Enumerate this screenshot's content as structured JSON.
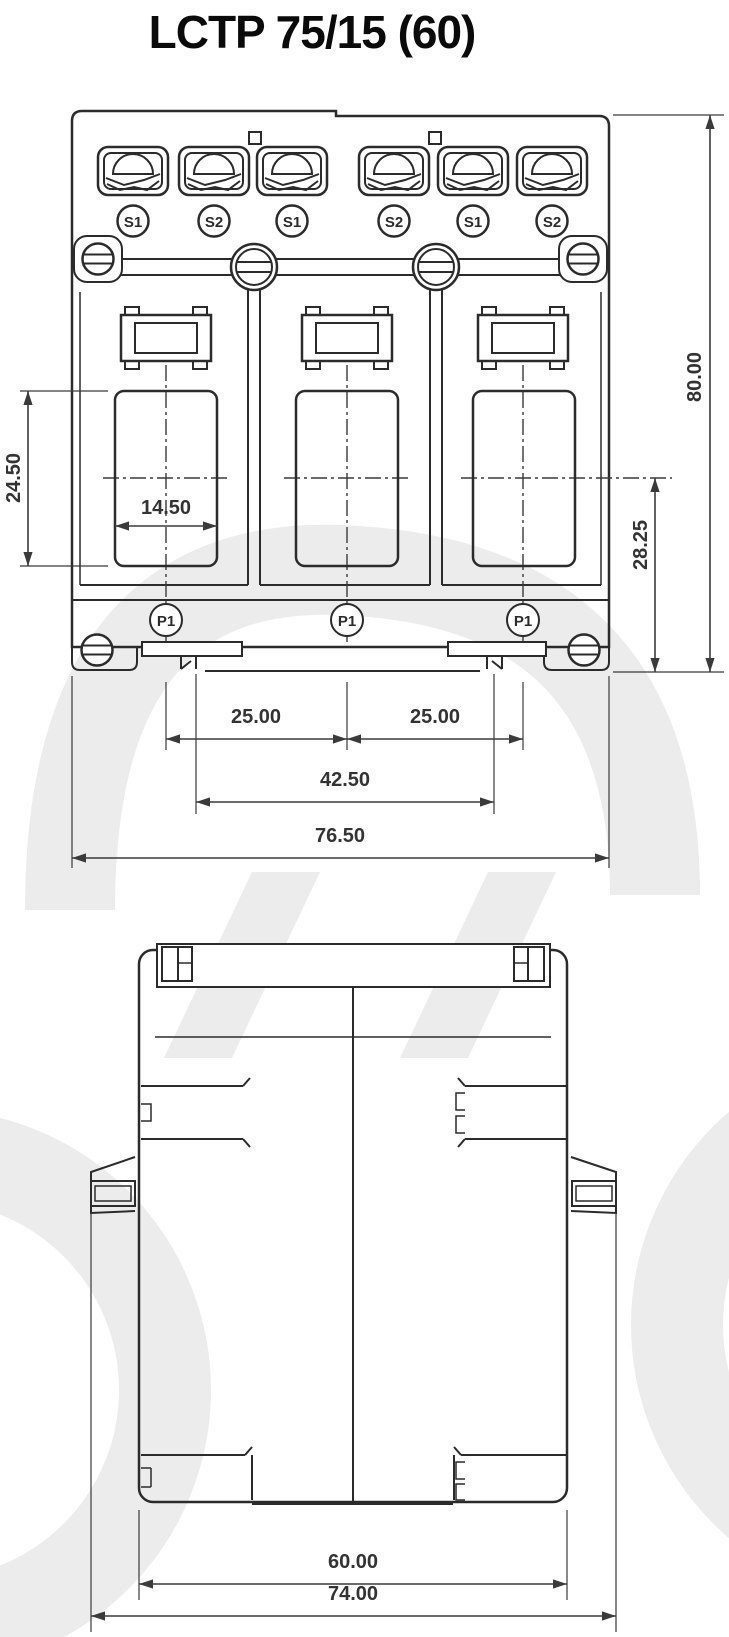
{
  "title": "LCTP 75/15 (60)",
  "front_view": {
    "terminal_labels": [
      "S1",
      "S2",
      "S1",
      "S2",
      "S1",
      "S2"
    ],
    "primary_labels": [
      "P1",
      "P1",
      "P1"
    ],
    "dimensions": {
      "window_height": "24.50",
      "window_width": "14.50",
      "pole_pitch_left": "25.00",
      "pole_pitch_right": "25.00",
      "fixing_span": "42.50",
      "overall_width": "76.50",
      "center_to_base": "28.25",
      "overall_height": "80.00"
    }
  },
  "side_view": {
    "dimensions": {
      "body_depth": "60.00",
      "overall_depth": "74.00"
    }
  },
  "colors": {
    "line": "#2b2b2b",
    "dimension": "#3a3a3a",
    "watermark": "#ececec",
    "background": "#ffffff"
  }
}
